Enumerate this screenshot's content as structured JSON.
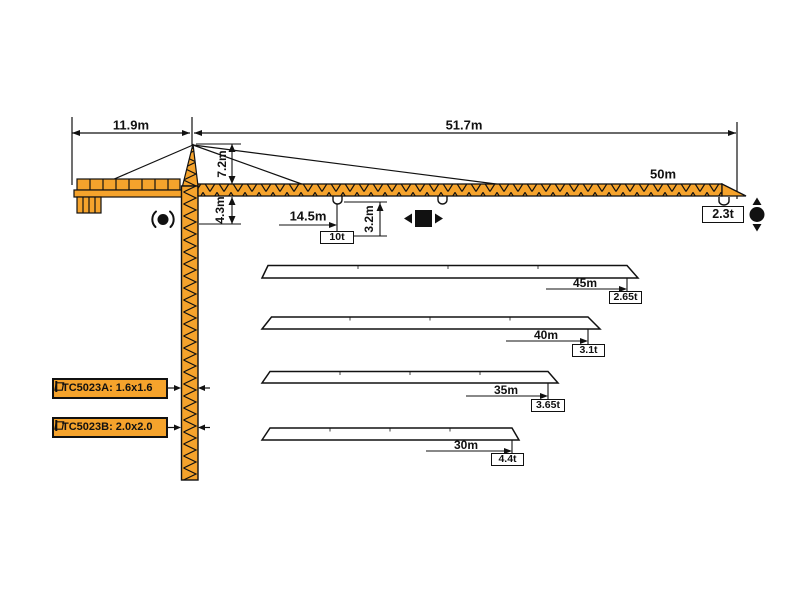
{
  "colors": {
    "crane_orange": "#F5A32C",
    "line_black": "#111111",
    "background": "#ffffff"
  },
  "top_dimensions": {
    "counter_jib": "11.9m",
    "jib": "51.7m"
  },
  "tower": {
    "head_height": "7.2m",
    "slewing_height": "4.3m"
  },
  "main_jib": {
    "length": "50m",
    "max_load_radius": "14.5m",
    "max_load": "10t",
    "tip_load": "2.3t",
    "hook_dimension": "3.2m"
  },
  "jib_variants": [
    {
      "length": "45m",
      "tip_load": "2.65t"
    },
    {
      "length": "40m",
      "tip_load": "3.1t"
    },
    {
      "length": "35m",
      "tip_load": "3.65t"
    },
    {
      "length": "30m",
      "tip_load": "4.4t"
    }
  ],
  "models": [
    {
      "label": "TC5023A: 1.6x1.6"
    },
    {
      "label": "TC5023B: 2.0x2.0"
    }
  ],
  "icons": {
    "slewing": "slewing-icon",
    "trolley": "trolley-travel-icon",
    "hoist": "hoist-icon",
    "mast_section": "mast-section-icon"
  }
}
